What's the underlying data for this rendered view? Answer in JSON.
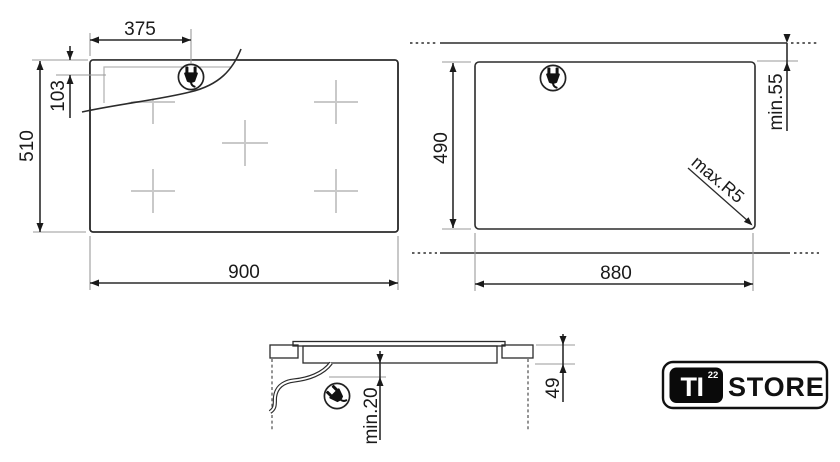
{
  "top_view": {
    "width": "900",
    "depth": "510",
    "plug_offset_x": "375",
    "plug_offset_y": "103"
  },
  "cutout_view": {
    "width": "880",
    "depth": "490",
    "rear_clearance": "min.55",
    "corner_radius": "max.R5"
  },
  "side_view": {
    "under_clearance": "min.20",
    "recess_depth": "49"
  },
  "logo": {
    "brand": "TI",
    "brand_sup": "22",
    "store": "STORE"
  },
  "colors": {
    "line": "#2b2b2b",
    "extension_line": "#9a9a9a",
    "burner_cross": "#c9c9c9",
    "logo_black": "#0a0a0a",
    "background": "#ffffff"
  }
}
